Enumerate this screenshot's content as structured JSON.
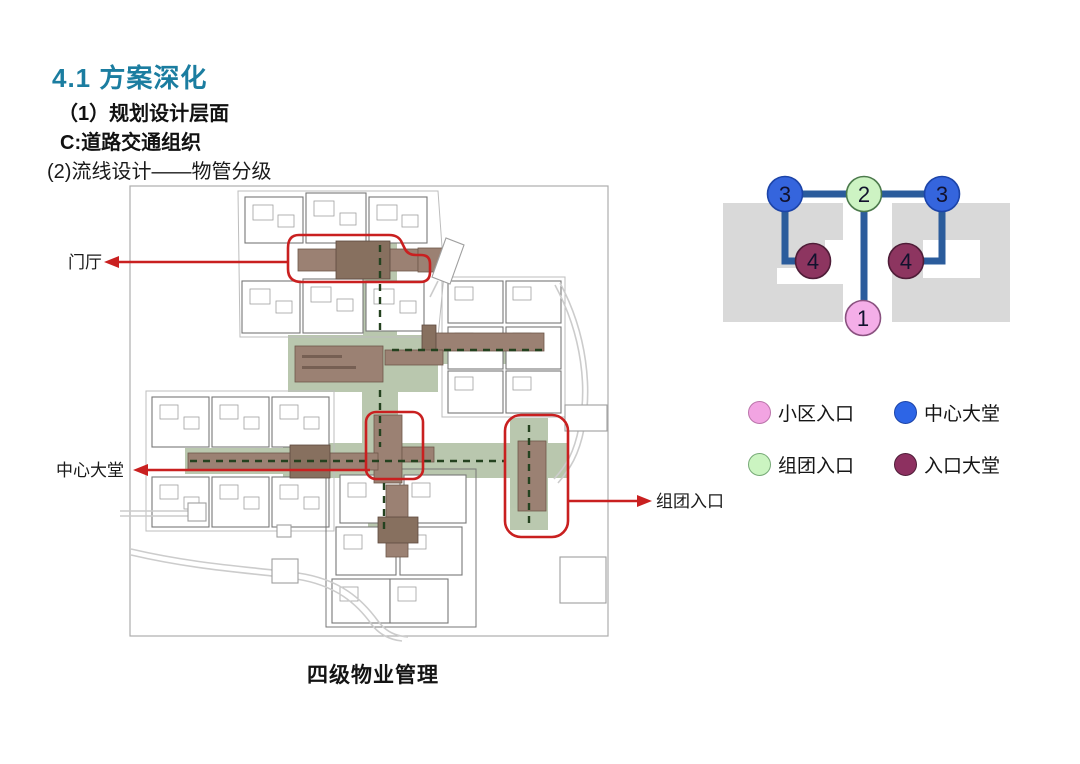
{
  "header": {
    "title": "4.1 方案深化",
    "title_color": "#1b7da0",
    "subtitle1": "（1）规划设计层面",
    "subtitle2": "C:道路交通组织",
    "subtitle3": "(2)流线设计——物管分级"
  },
  "plan": {
    "caption": "四级物业管理",
    "annotation_color": "#c92020",
    "annotations": {
      "lobby": "门厅",
      "central_hall": "中心大堂",
      "cluster_entrance": "组团入口"
    }
  },
  "hierarchy_diagram": {
    "edge_color": "#2b5c9c",
    "edge_width": 7,
    "node_radius": 17.5,
    "number_color": "#12122e",
    "block_color": "#d9d9d9",
    "nodes": [
      {
        "label": "1",
        "type": "小区入口",
        "fill": "#f4aee8",
        "stroke": "#8a5280",
        "x": 153,
        "y": 158
      },
      {
        "label": "2",
        "type": "组团入口",
        "fill": "#cdf3c3",
        "stroke": "#4c7a4c",
        "x": 154,
        "y": 34
      },
      {
        "label": "3",
        "type": "中心大堂",
        "fill": "#3565dd",
        "stroke": "#1c44a8",
        "x": 75,
        "y": 34
      },
      {
        "label": "3",
        "type": "中心大堂",
        "fill": "#3565dd",
        "stroke": "#1c44a8",
        "x": 232,
        "y": 34
      },
      {
        "label": "4",
        "type": "入口大堂",
        "fill": "#8d3560",
        "stroke": "#4f1d38",
        "x": 103,
        "y": 101
      },
      {
        "label": "4",
        "type": "入口大堂",
        "fill": "#8d3560",
        "stroke": "#4f1d38",
        "x": 196,
        "y": 101
      }
    ],
    "edges": [
      {
        "points": [
          [
            75,
            34
          ],
          [
            232,
            34
          ]
        ]
      },
      {
        "points": [
          [
            75,
            34
          ],
          [
            75,
            101
          ],
          [
            103,
            101
          ]
        ]
      },
      {
        "points": [
          [
            232,
            34
          ],
          [
            232,
            101
          ],
          [
            196,
            101
          ]
        ]
      },
      {
        "points": [
          [
            154,
            34
          ],
          [
            154,
            158
          ]
        ]
      }
    ]
  },
  "legend": {
    "items": [
      {
        "label": "小区入口",
        "fill": "#f2a4e2",
        "stroke": "#bb74ab"
      },
      {
        "label": "中心大堂",
        "fill": "#2d65e6",
        "stroke": "#1c44a8"
      },
      {
        "label": "组团入口",
        "fill": "#cbf4c1",
        "stroke": "#77aa77"
      },
      {
        "label": "入口大堂",
        "fill": "#8d3060",
        "stroke": "#4f1d38"
      }
    ]
  }
}
